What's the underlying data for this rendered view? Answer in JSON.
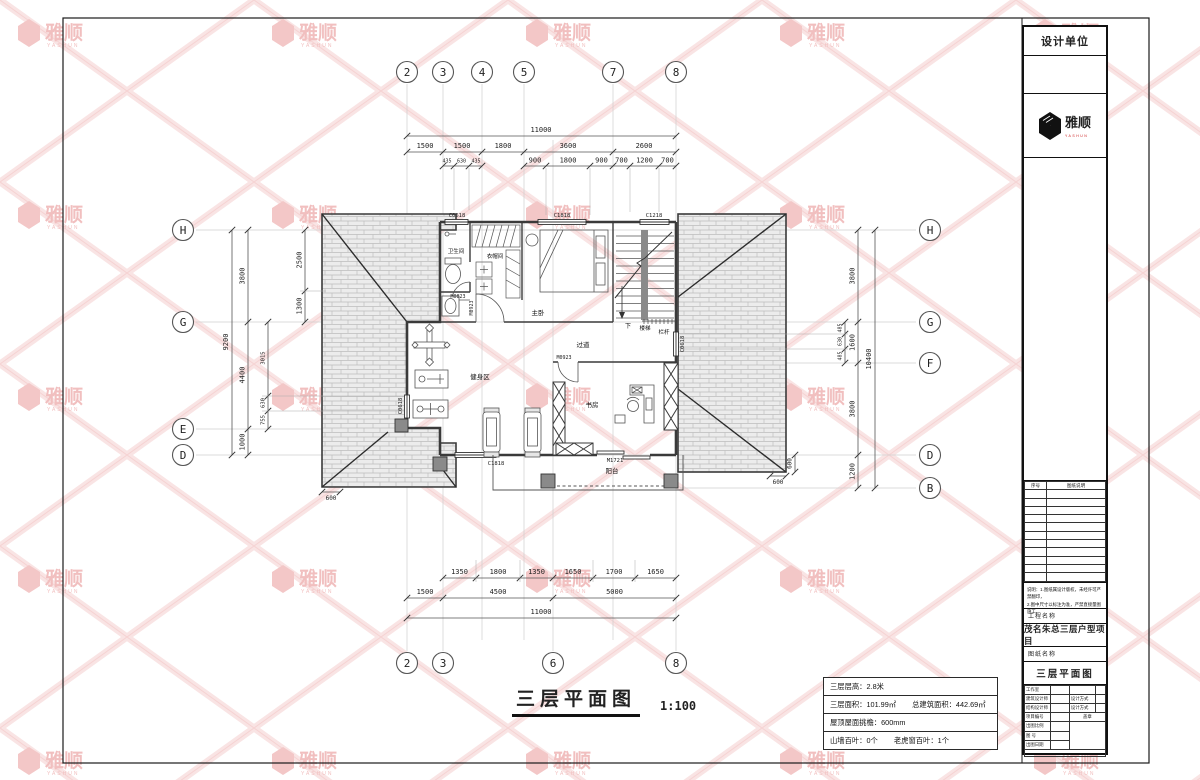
{
  "watermark": {
    "brand": "雅顺",
    "brand_sub": "YASHUN"
  },
  "title_block": {
    "design_unit": "设计单位",
    "brand": "雅顺",
    "brand_sub": "YASHUN",
    "list_header": {
      "no": "序号",
      "desc": "图纸说明"
    },
    "notes_line1": "说明：1.图纸属设计版权，未经许可严禁翻印，",
    "notes_line2": "2.图中尺寸以标注为准，严禁直接量图施工。",
    "project_label": "工程名称",
    "project_name": "茂名朱总三层户型项目",
    "drawing_label": "图纸名称",
    "drawing_name": "三层平面图",
    "rows": {
      "studio": "工作室",
      "arch": "建筑设计师",
      "arch_mode": "设计方式",
      "struct": "结构设计师",
      "struct_mode": "设计方式",
      "proj_no": "项目编号",
      "stamp": "盖章",
      "scale": "出图比例",
      "fig_no": "图 号",
      "date": "出图日期"
    }
  },
  "footer": {
    "title": "三层平面图",
    "scale": "1:100"
  },
  "info_table": {
    "row1_label": "三层层高：",
    "row1_value": "2.8米",
    "row2a_label": "三层面积：",
    "row2a_value": "101.99㎡",
    "row2b_label": "总建筑面积：",
    "row2b_value": "442.69㎡",
    "row3_label": "屋顶屋面挑檐：",
    "row3_value": "600mm",
    "row4a_label": "山墙百叶：",
    "row4a_value": "0个",
    "row4b_label": "老虎窗百叶：",
    "row4b_value": "1个"
  },
  "grid": {
    "top": [
      "2",
      "3",
      "4",
      "5",
      "7",
      "8"
    ],
    "bottom": [
      "2",
      "3",
      "6",
      "8"
    ],
    "left": [
      "H",
      "G",
      "E",
      "D"
    ],
    "right": [
      "H",
      "G",
      "F",
      "D",
      "B"
    ]
  },
  "dims": {
    "top_total": "11000",
    "top_seg": [
      "1500",
      "1500",
      "1800",
      "3600",
      "2600"
    ],
    "top_sub": [
      "435",
      "630",
      "435",
      "900",
      "1800",
      "900",
      "700",
      "1200",
      "700"
    ],
    "bottom_sub": [
      "1350",
      "1800",
      "1350",
      "1650",
      "1700",
      "1650"
    ],
    "bottom_seg": [
      "1500",
      "4500",
      "5000"
    ],
    "bottom_total": "11000",
    "left_total": "9200",
    "left_seg": [
      "3800",
      "4400",
      "1000"
    ],
    "left_sub_top": [
      "2500",
      "1300"
    ],
    "left_sub_bot": [
      "3015",
      "630",
      "755"
    ],
    "left_eave": "600",
    "right_total": "10400",
    "right_seg": [
      "3800",
      "1600",
      "3800",
      "1200"
    ],
    "right_sub": [
      "485",
      "630",
      "485"
    ],
    "right_eave_v": "600",
    "right_eave_h": "600"
  },
  "rooms": {
    "bathroom": "卫生间",
    "cloak": "衣帽间",
    "master": "主卧",
    "corridor": "过道",
    "gym": "健身区",
    "study": "书房",
    "balcony": "阳台",
    "stair": "楼梯",
    "down": "下",
    "rail": "栏杆"
  },
  "openings": {
    "c0618_top": "C0618",
    "c1818_top": "C1818",
    "c1218_top": "C1218",
    "m0823": "M0823",
    "m0923_v": "M0923",
    "m0923_h": "M0923",
    "c0618_left": "C0618",
    "c0618_right": "C0618",
    "c1818_bottom": "C1818",
    "m1721": "M1721"
  }
}
